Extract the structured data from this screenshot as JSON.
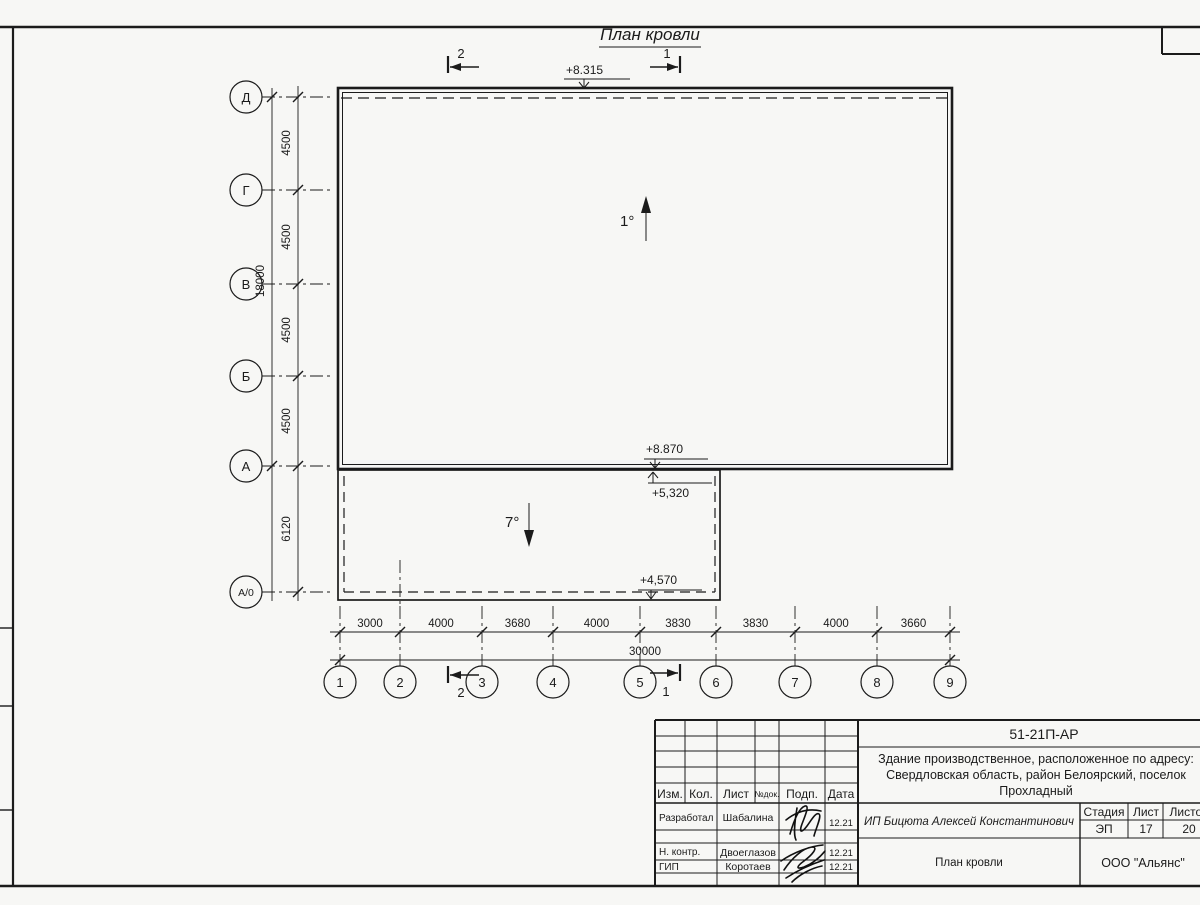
{
  "sheet": {
    "title": "План кровли"
  },
  "drawing": {
    "axes_vertical": [
      "Д",
      "Г",
      "В",
      "Б",
      "А",
      "А/0"
    ],
    "axes_horizontal": [
      "1",
      "2",
      "3",
      "4",
      "5",
      "6",
      "7",
      "8",
      "9"
    ],
    "dims_vertical": [
      "4500",
      "4500",
      "4500",
      "4500",
      "6120"
    ],
    "dim_vertical_total": "18000",
    "dims_horizontal": [
      "3000",
      "4000",
      "3680",
      "4000",
      "3830",
      "3830",
      "4000",
      "3660"
    ],
    "dim_horizontal_total": "30000",
    "elevations": {
      "roof_main": "+8.315",
      "roof_edge": "+8.870",
      "canopy_high": "+5,320",
      "canopy_low": "+4,570"
    },
    "slopes": {
      "main": "1°",
      "canopy": "7°"
    },
    "sections": {
      "s1": "1",
      "s2": "2"
    }
  },
  "titleblock": {
    "doc_number": "51-21П-АР",
    "description_lines": [
      "Здание производственное, расположенное по адресу:",
      "Свердловская область, район Белоярский, поселок",
      "Прохладный"
    ],
    "header_cols": [
      "Изм.",
      "Кол.",
      "Лист",
      "№док.",
      "Подп.",
      "Дата"
    ],
    "roles": [
      {
        "role": "Разработал",
        "name": "Шабалина",
        "date": "12.21"
      },
      {
        "role": "Н. контр.",
        "name": "Двоеглазов",
        "date": "12.21"
      },
      {
        "role": "ГИП",
        "name": "Коротаев",
        "date": "12.21"
      }
    ],
    "client": "ИП Бицюта Алексей Константинович",
    "stage_label": "Стадия",
    "sheet_label": "Лист",
    "sheets_label": "Листов",
    "stage": "ЭП",
    "sheet_no": "17",
    "sheets_total": "20",
    "drawing_name": "План кровли",
    "company": "ООО \"Альянс\""
  }
}
